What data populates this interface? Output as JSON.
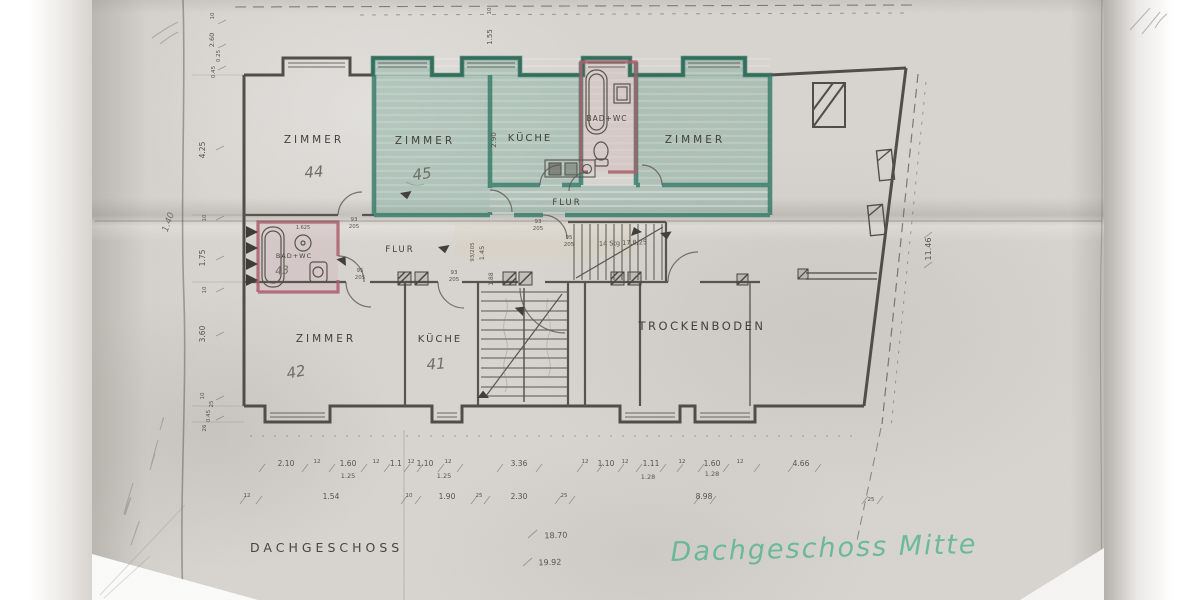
{
  "document": {
    "printed_title": "DACHGESCHOSS",
    "handwritten_title": "Dachgeschoss Mitte",
    "colors": {
      "paper": "#d8d5d0",
      "ink": "#4b4944",
      "green_highlight": "#4e9c82",
      "pink_highlight": "#b46f7d",
      "pencil": "#75736c",
      "marker_green": "#54b291"
    }
  },
  "rooms": {
    "zimmer44": {
      "label": "ZIMMER",
      "number": "44"
    },
    "zimmer45": {
      "label": "ZIMMER",
      "number": "45"
    },
    "kueche_top": {
      "label": "KÜCHE"
    },
    "bad_top": {
      "label": "BAD+WC"
    },
    "zimmer_top_right": {
      "label": "ZIMMER"
    },
    "flur_top": {
      "label": "FLUR"
    },
    "flur_low": {
      "label": "FLUR"
    },
    "bad43": {
      "label": "BAD+WC",
      "number": "43"
    },
    "zimmer42": {
      "label": "ZIMMER",
      "number": "42"
    },
    "kueche41": {
      "label": "KÜCHE",
      "number": "41"
    },
    "trockenboden": {
      "label": "TROCKENBODEN"
    }
  },
  "stairs": {
    "note": "14 Stg 17,8/25"
  },
  "dims": {
    "left_chain": [
      "10",
      "2.60",
      "0.25",
      "0.45",
      "4.25",
      "10",
      "1.75",
      "10",
      "3.60",
      "10",
      "25",
      "0.45",
      "26"
    ],
    "top10": "10",
    "top155": "1.55",
    "v290": "2.90",
    "v93205": "93/205",
    "v145": "1.45",
    "v188": "1.88",
    "right": "11.46",
    "row1": [
      "2.10",
      "12",
      "1.60",
      "12",
      "1.1",
      "12",
      "1.10",
      "12",
      "3.36",
      "12",
      "1.10",
      "12",
      "1.11",
      "12",
      "1.60",
      "12",
      "4.66"
    ],
    "row1b": [
      "1.25",
      "1.25",
      "1.28",
      "1.28"
    ],
    "row2": [
      "12",
      "1.54",
      "10",
      "1.90",
      "25",
      "2.30",
      "25",
      "8.98",
      "25"
    ],
    "door_pairs": [
      [
        "93",
        "205"
      ],
      [
        "93",
        "205"
      ],
      [
        "95",
        "205"
      ],
      [
        "93",
        "205"
      ],
      [
        "95",
        "205"
      ]
    ],
    "bad43_w": "1.625",
    "total_upper": "18.70",
    "total_lower": "19.92",
    "pencil_140": "1.40"
  }
}
